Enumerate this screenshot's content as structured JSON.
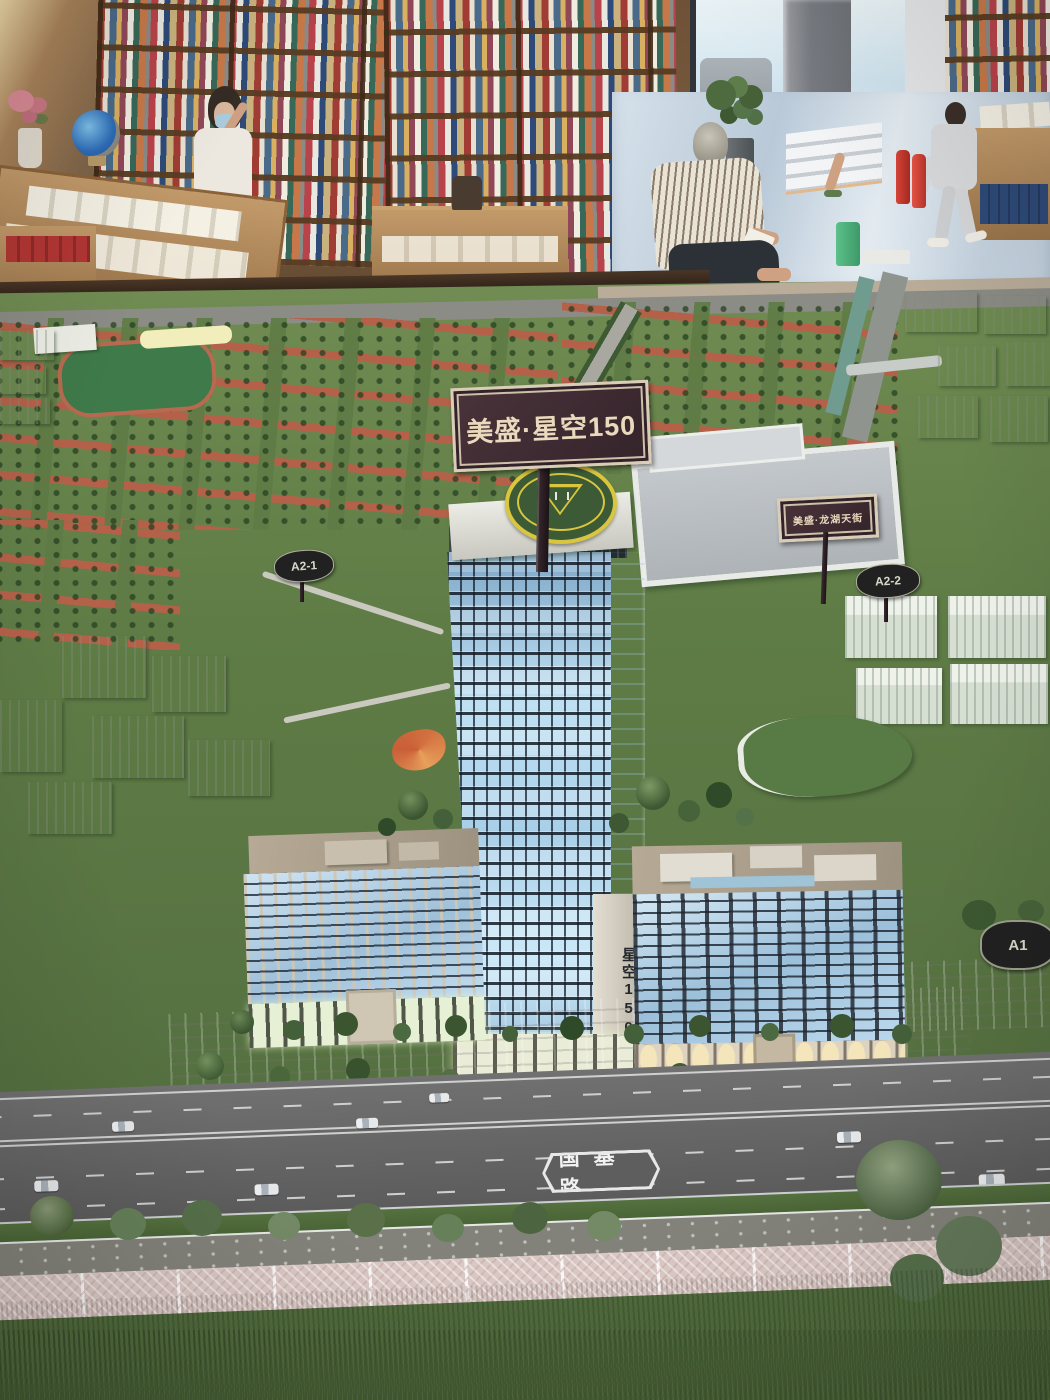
{
  "scene": {
    "setting": "bookstore showroom with an illuminated architectural scale model",
    "subject": "real-estate development model with lit high-rise tower"
  },
  "signs": {
    "main_board": "美盛·星空150",
    "mall_board": "美盛·龙湖天街",
    "tower_pillar_vertical": "星空150",
    "plot_a2_1": "A2-1",
    "plot_a2_2": "A2-2",
    "plot_a1": "A1",
    "road_label": "国基路"
  },
  "colors": {
    "sign_board": "#3f2a30",
    "sign_text": "#ead9bd",
    "tower_window_glow": "#bfe3f5",
    "terracotta_block": "#b5614a",
    "model_grass": "#5f7c46",
    "foreground_grass": "#3a5429",
    "road_asphalt": "#616161",
    "marble_floor": "#c7d5e2",
    "bookshelf_wood": "#7b5a39",
    "helipad_ring": "#d9c63e"
  }
}
